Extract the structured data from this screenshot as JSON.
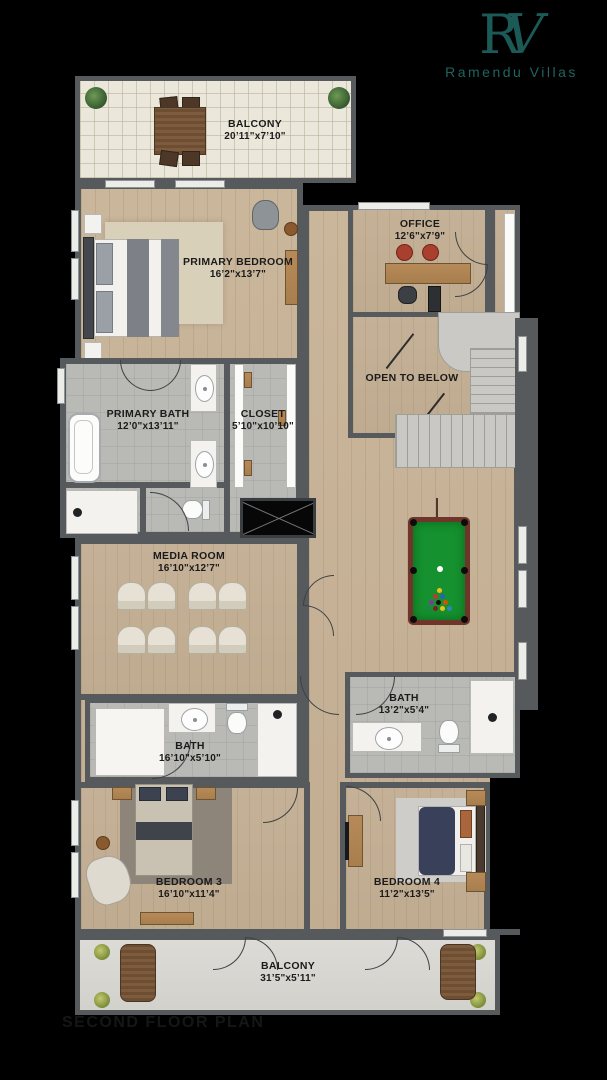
{
  "brand": {
    "monogram_r": "R",
    "monogram_v": "V",
    "name": "Ramendu Villas",
    "accent_color": "#1c5a57"
  },
  "plan_title": "SECOND FLOOR PLAN",
  "rooms": {
    "balcony_top": {
      "name": "BALCONY",
      "dims": "20’11\"x7’10\""
    },
    "primary_bedroom": {
      "name": "PRIMARY BEDROOM",
      "dims": "16’2\"x13’7\""
    },
    "office": {
      "name": "OFFICE",
      "dims": "12’6\"x7’9\""
    },
    "primary_bath": {
      "name": "PRIMARY BATH",
      "dims": "12’0\"x13’11\""
    },
    "closet": {
      "name": "CLOSET",
      "dims": "5’10\"x10’10\""
    },
    "open_to_below": {
      "name": "OPEN TO BELOW"
    },
    "media_room": {
      "name": "MEDIA ROOM",
      "dims": "16’10\"x12’7\""
    },
    "bath_right": {
      "name": "BATH",
      "dims": "13’2\"x5’4\""
    },
    "bath_left": {
      "name": "BATH",
      "dims": "16’10\"x5’10\""
    },
    "bedroom_3": {
      "name": "BEDROOM 3",
      "dims": "16’10\"x11’4\""
    },
    "bedroom_4": {
      "name": "BEDROOM 4",
      "dims": "11’2\"x13’5\""
    },
    "balcony_bottom": {
      "name": "BALCONY",
      "dims": "31’5\"x5’11\""
    }
  },
  "colors": {
    "background": "#000000",
    "wall": "#565a5d",
    "wood_floor": "#c6b299",
    "tile_floor": "#b9b9b6",
    "balcony_tile": "#ebe8db",
    "pool_felt": "#15912f",
    "pool_rail": "#70352a",
    "label_text": "#1b1b1b"
  },
  "icons": {
    "plant-icon": "css-radial-circle",
    "stair-arrow-icon": "css-line"
  }
}
